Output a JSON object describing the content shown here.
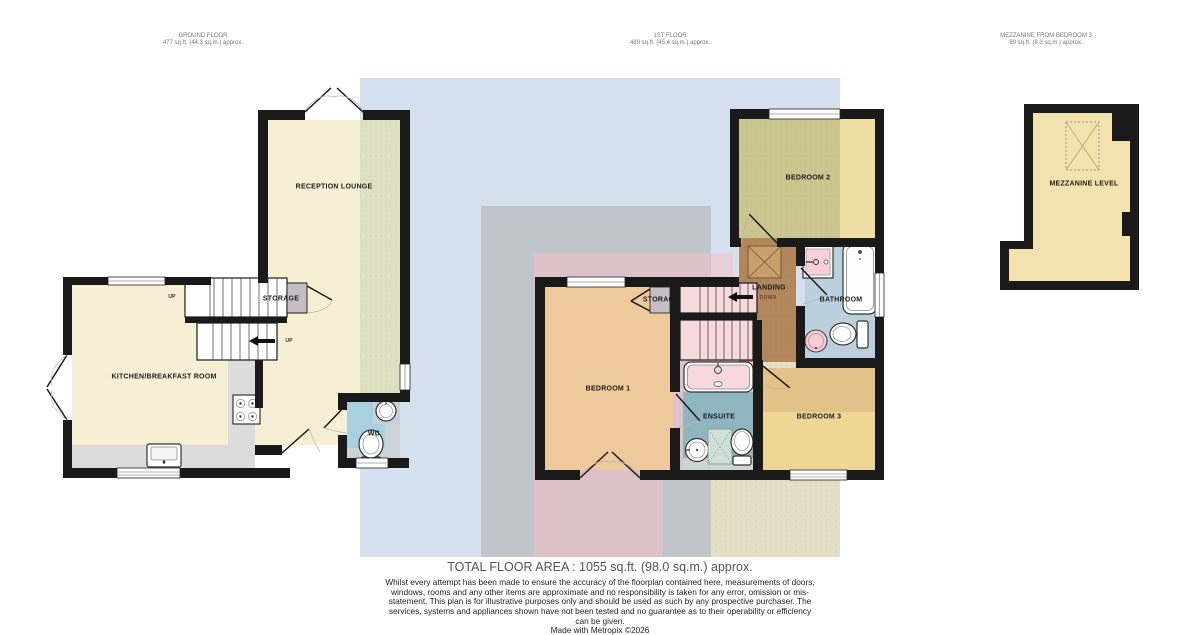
{
  "headers": {
    "ground": {
      "line1": "GROUND FLOOR",
      "line2": "477 sq.ft. (44.3 sq.m.) approx."
    },
    "first": {
      "line1": "1ST FLOOR",
      "line2": "489 sq.ft. (45.4 sq.m.) approx."
    },
    "mezzanine": {
      "line1": "MEZZANINE FROM BEDROOM 3",
      "line2": "89 sq.ft. (8.3 sq.m.) approx."
    }
  },
  "rooms": {
    "reception_lounge": "RECEPTION LOUNGE",
    "kitchen": "KITCHEN/BREAKFAST ROOM",
    "storage_ground": "STORAGE",
    "wc": "WC",
    "bedroom1": "BEDROOM 1",
    "bedroom2": "BEDROOM 2",
    "bedroom3": "BEDROOM 3",
    "bathroom": "BATHROOM",
    "ensuite": "ENSUITE",
    "landing": "LANDING",
    "storage_first": "STORAGE",
    "mezzanine": "MEZZANINE LEVEL"
  },
  "stairs": {
    "up_top": "UP",
    "up_bottom": "UP",
    "down": "DOWN"
  },
  "footer": {
    "total": "TOTAL FLOOR AREA : 1055 sq.ft. (98.0 sq.m.) approx.",
    "disclaimer": "Whilst every attempt has been made to ensure the accuracy of the floorplan contained here, measurements of doors, windows, rooms and any other items are approximate and no responsibility is taken for any error, omission or mis-statement. This plan is for illustrative purposes only and should be used as such by any prospective purchaser. The services, systems and appliances shown have not been tested and no guarantee as to their operability or efficiency can be given.",
    "made_with": "Made with Metropix ©2026"
  },
  "colors": {
    "wall": "#1a1a1a",
    "cream": "#f6efd4",
    "lounge_tint": "#dfe0c2",
    "blue_zone": "#adc4dc",
    "gray_zone": "#a9a9a9",
    "pink_zone": "#f5bfc9",
    "cream_zone": "#f0ddae",
    "counter": "#dcdcdc",
    "bedroom1": "#edc99c",
    "bedroom2_tint": "#cbc68f",
    "bedroom2": "#f0dfa2",
    "bedroom3": "#eed794",
    "bedroom3_band": "#e3c28a",
    "bathroom": "#bccfdd",
    "ensuite": "#8fb6bf",
    "wc_floor": "#a8d0e0",
    "wc_gray": "#cdd4d9",
    "landing_brown": "#b2875c",
    "stair_pink": "#f7d9dd",
    "storage_gray": "#c4bec2",
    "mezzanine_fill": "#f2e2ae",
    "skylight": "#c99f6d"
  }
}
